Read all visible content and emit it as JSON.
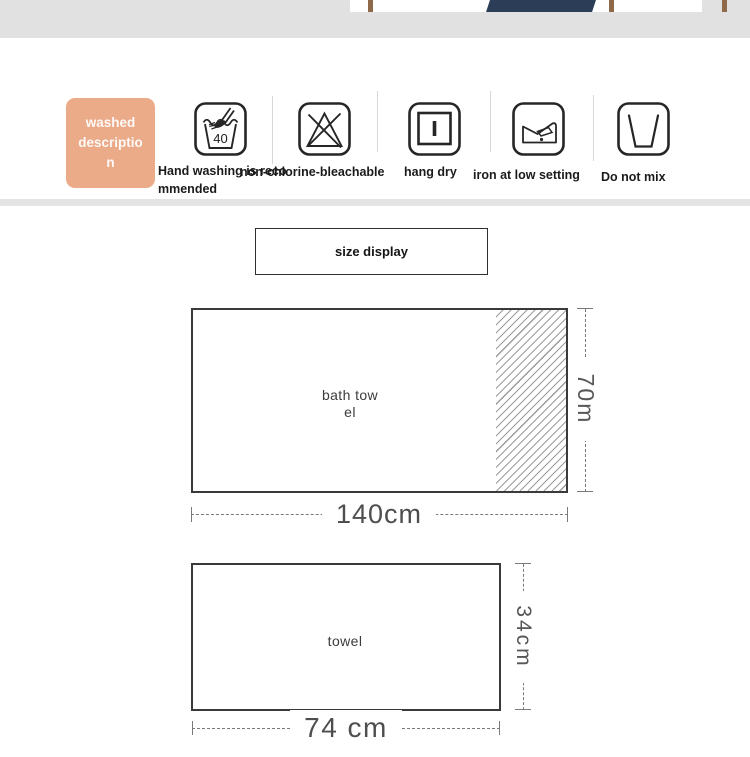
{
  "care": {
    "badge": {
      "line1": "washed",
      "line2": "descriptio",
      "line3": "n",
      "bg_color": "#ebab89"
    },
    "items": [
      {
        "icon": "hand-wash-40-icon",
        "icon_text": "40",
        "label": "Hand washing is recommended"
      },
      {
        "icon": "no-chlorine-bleach-icon",
        "label": "non-chlorine-bleachable"
      },
      {
        "icon": "hang-dry-icon",
        "label": "hang dry"
      },
      {
        "icon": "iron-low-setting-icon",
        "label": "iron at low setting"
      },
      {
        "icon": "do-not-mix-icon",
        "label": "Do not mix"
      }
    ]
  },
  "size_section": {
    "title": "size display",
    "bath_towel": {
      "label_line1": "bath tow",
      "label_line2": "el",
      "width_label": "140cm",
      "height_label": "70m"
    },
    "towel": {
      "label": "towel",
      "width_label": "74 cm",
      "height_label": "34cm"
    }
  },
  "colors": {
    "badge_bg": "#ebab89",
    "top_band_gray": "#e1e1e2",
    "divider_strip_gray": "#e4e4e4",
    "icon_stroke": "#262626",
    "rect_outline": "#3a3a3a",
    "dimension_line": "#7a7a7a",
    "photo_navy": "#2c3d58",
    "photo_wood": "#8f6a4a"
  }
}
